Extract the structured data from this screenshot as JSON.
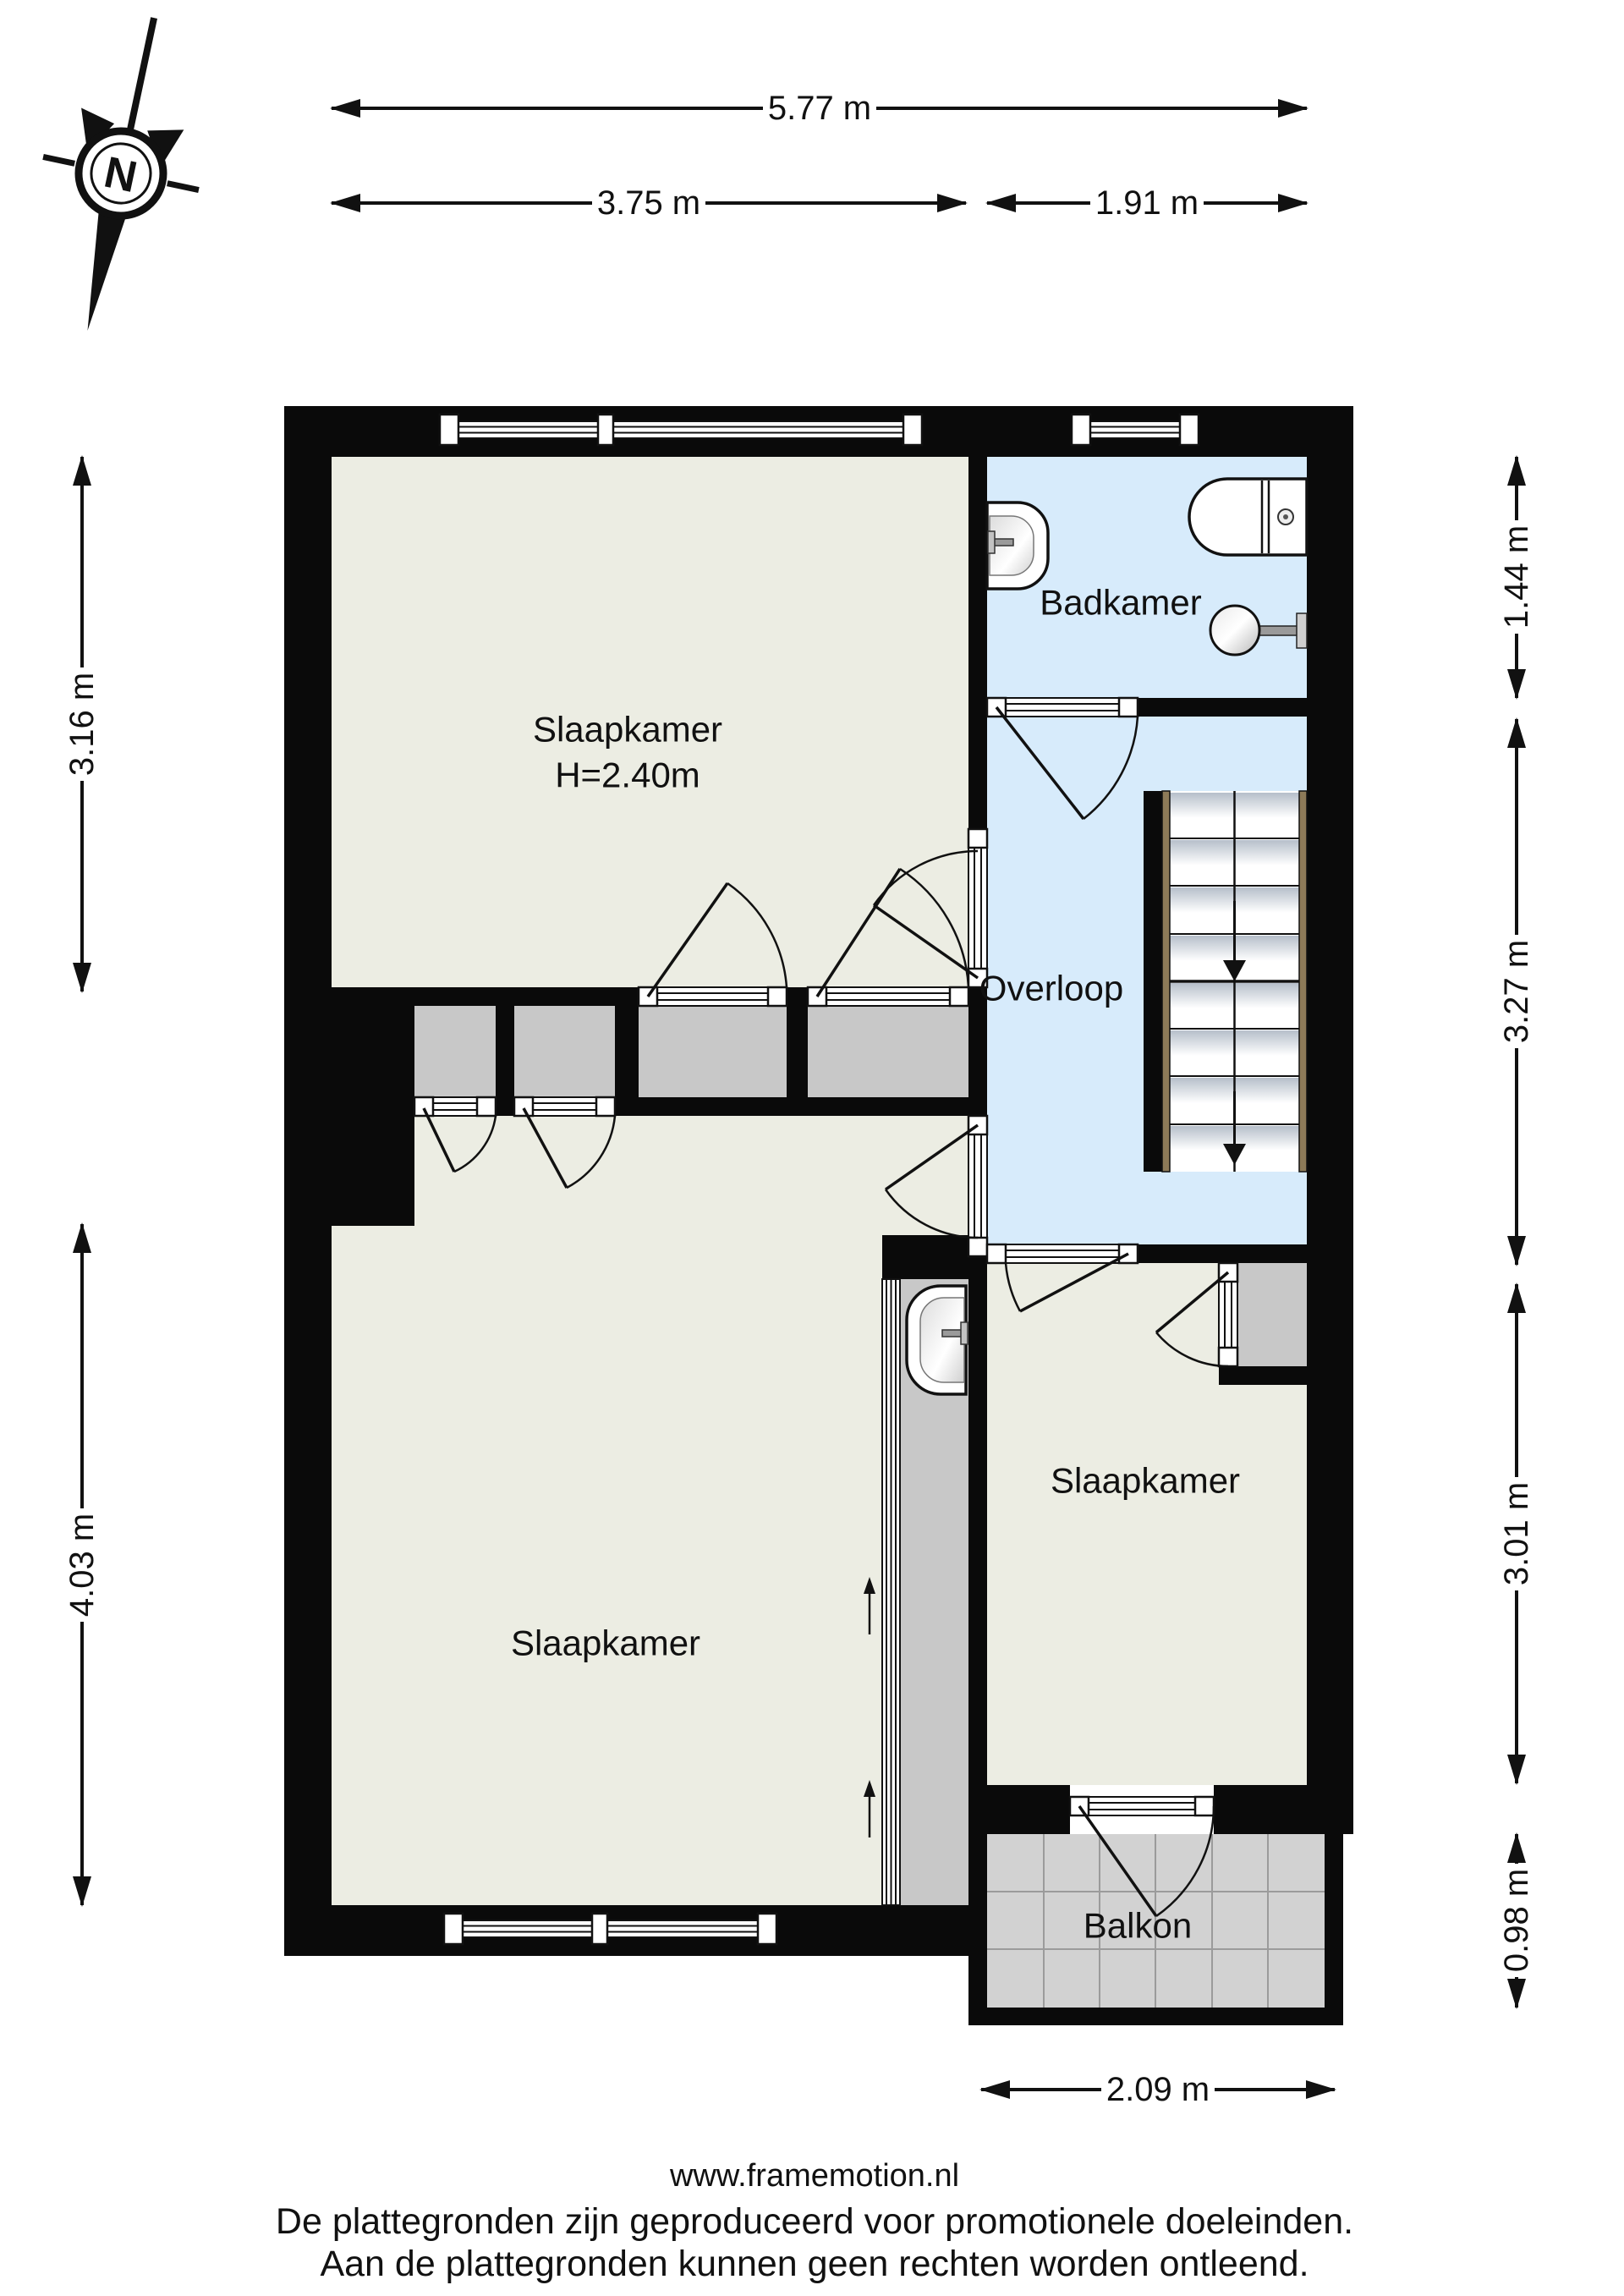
{
  "compass": {
    "letter": "N",
    "icon": "compass-rose-icon"
  },
  "rooms": {
    "bedroom_top": {
      "label": "Slaapkamer",
      "ceiling": "H=2.40m"
    },
    "bathroom": {
      "label": "Badkamer"
    },
    "landing": {
      "label": "Overloop"
    },
    "bedroom_left": {
      "label": "Slaapkamer"
    },
    "bedroom_right": {
      "label": "Slaapkamer"
    },
    "balcony": {
      "label": "Balkon"
    }
  },
  "dimensions": {
    "top_total": "5.77 m",
    "top_left": "3.75 m",
    "top_right": "1.91 m",
    "left_upper": "3.16 m",
    "left_lower": "4.03 m",
    "right_bathroom": "1.44 m",
    "right_landing": "3.27 m",
    "right_bedroom": "3.01 m",
    "right_balcony": "0.98 m",
    "bottom_balcony": "2.09 m"
  },
  "fixtures": {
    "bathroom_sink": "washbasin-icon",
    "toilet": "toilet-icon",
    "fountain": "round-basin-icon",
    "niche_sink": "washbasin-icon",
    "stairs": "staircase-down-icon"
  },
  "footer": {
    "line1": "www.framemotion.nl",
    "line2": "De plattegronden zijn geproduceerd voor promotionele doeleinden.",
    "line3": "Aan de plattegronden kunnen geen rechten worden ontleend."
  },
  "colors": {
    "room_fill": "#ecede3",
    "wet_room_fill": "#d7ebfb",
    "closet_fill": "#c8c8c8",
    "balcony_fill": "#d2d2d2",
    "wall": "#0a0a0a",
    "stair_stringer": "#8d7a58"
  }
}
